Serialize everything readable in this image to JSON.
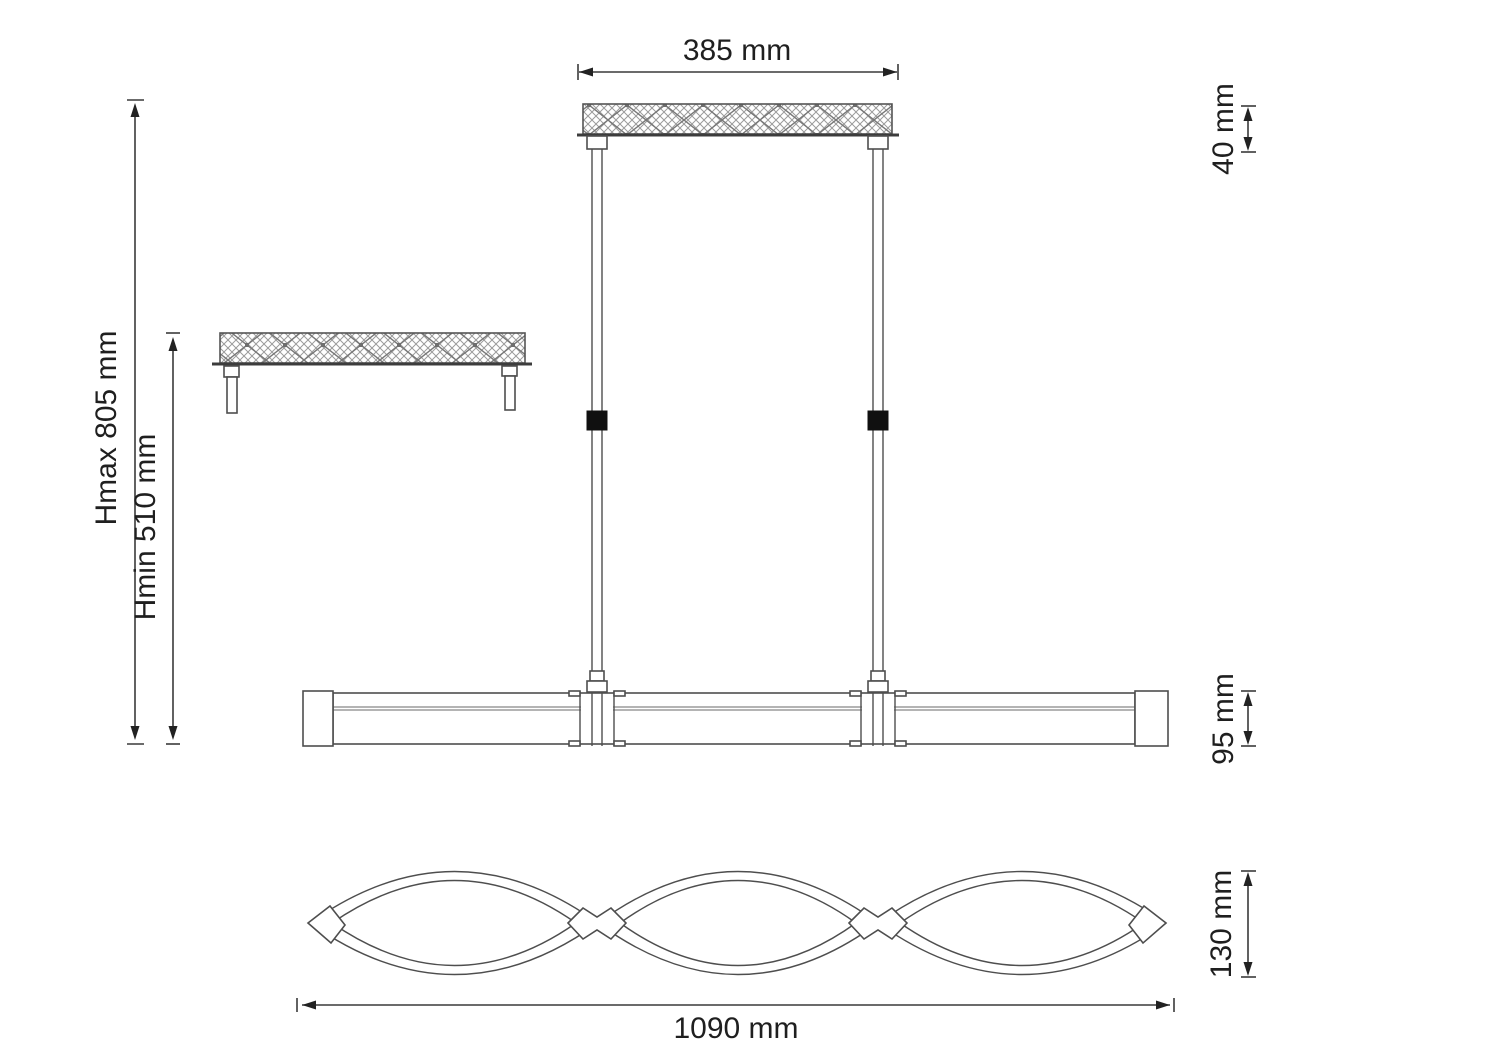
{
  "dimensions": {
    "canopy_width": "385 mm",
    "canopy_height": "40 mm",
    "max_height": "Hmax 805 mm",
    "min_height": "Hmin 510 mm",
    "body_height": "95 mm",
    "body_depth": "130 mm",
    "body_length": "1090 mm"
  },
  "colors": {
    "background": "#ffffff",
    "line": "#4e4e4e",
    "dimension_line": "#3a3a3a",
    "text": "#1f1f1f",
    "adjuster_black": "#101010",
    "hatch": "#9b9b9b"
  }
}
